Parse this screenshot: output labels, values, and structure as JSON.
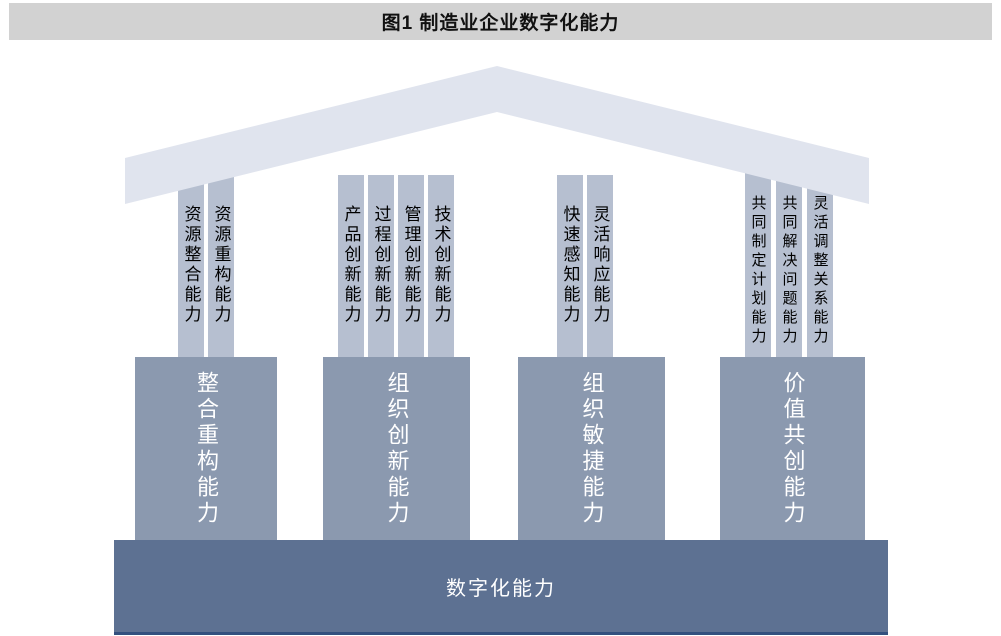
{
  "figure": {
    "title": "图1 制造业企业数字化能力"
  },
  "diagram": {
    "roof": "roof-chevron",
    "groups": [
      {
        "column": "整合重构能力",
        "pillars": [
          "资源整合能力",
          "资源重构能力"
        ]
      },
      {
        "column": "组织创新能力",
        "pillars": [
          "产品创新能力",
          "过程创新能力",
          "管理创新能力",
          "技术创新能力"
        ]
      },
      {
        "column": "组织敏捷能力",
        "pillars": [
          "快速感知能力",
          "灵活响应能力"
        ]
      },
      {
        "column": "价值共创能力",
        "pillars": [
          "共同制定计划能力",
          "共同解决问题能力",
          "灵活调整关系能力"
        ]
      }
    ],
    "base": "数字化能力"
  },
  "colors": {
    "title_bar": "#d2d2d2",
    "roof": "#e0e4ee",
    "pillar": "#b6bfd0",
    "column": "#8b99af",
    "base": "#5d7192",
    "base_border": "#33507e",
    "pillar_text": "#000000",
    "column_text": "#ffffff",
    "title_text": "#111111"
  }
}
